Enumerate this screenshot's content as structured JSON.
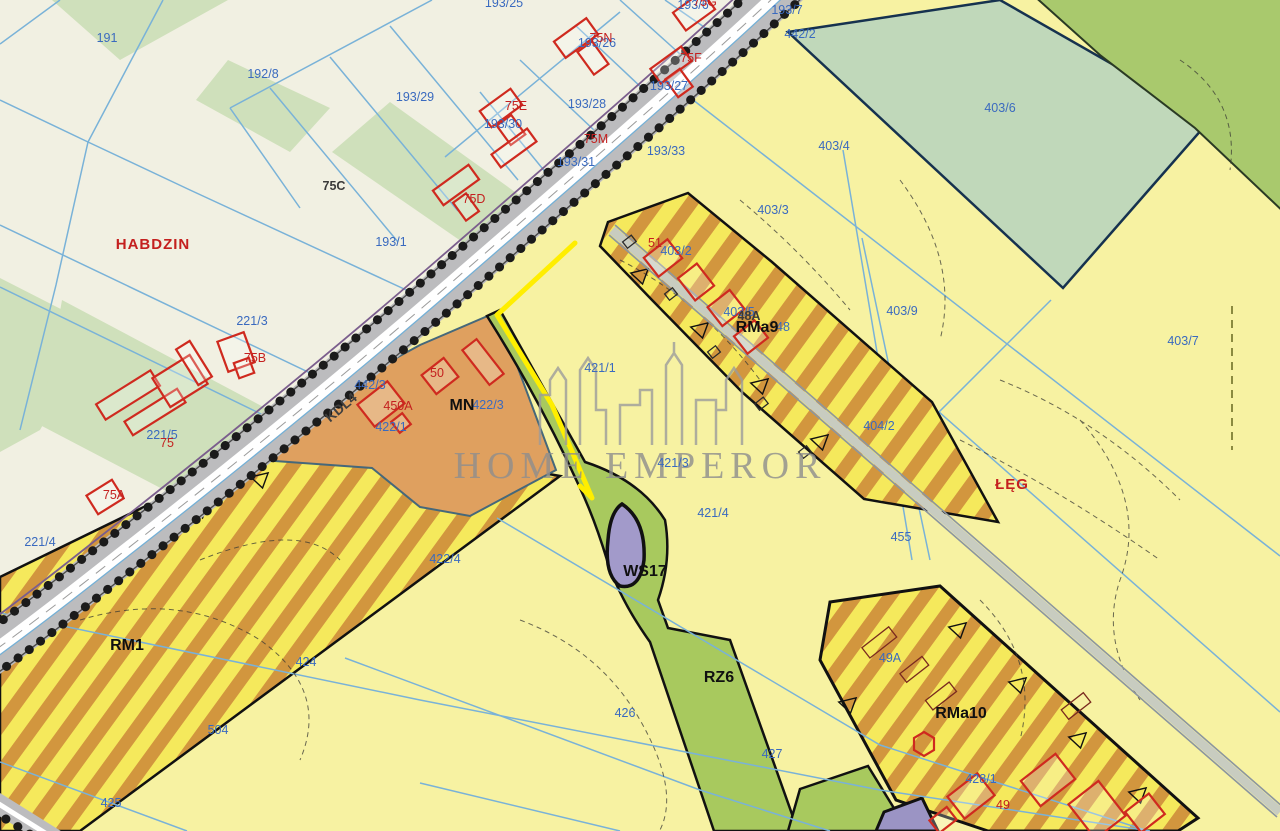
{
  "watermark": {
    "text": "HOME EMPEROR",
    "logo": "city-skyline-icon"
  },
  "colors": {
    "background_cream": "#f1f0e2",
    "parcel_yellow": "#f7f2a2",
    "stripe_yellow": "#f5e95c",
    "stripe_orange": "#d2963e",
    "zone_orange_mn": "#dfa05f",
    "zone_green": "#a8c95e",
    "forest_green": "#a9c96d",
    "meadow_sage": "#c0d8ba",
    "pond_purple": "#a29aca",
    "parcel_label_blue": "#3a6abf",
    "house_label_red": "#c4201f",
    "plan_boundary_yellow": "#ffee00",
    "nw_green_patch": "#cfe0bb"
  },
  "labels": [
    {
      "text": "191",
      "x": 107,
      "y": 42,
      "kind": "parcel"
    },
    {
      "text": "192/8",
      "x": 263,
      "y": 78,
      "kind": "parcel"
    },
    {
      "text": "193/29",
      "x": 415,
      "y": 101,
      "kind": "parcel"
    },
    {
      "text": "193/25",
      "x": 504,
      "y": 7,
      "kind": "parcel"
    },
    {
      "text": "193/26",
      "x": 597,
      "y": 47,
      "kind": "parcel"
    },
    {
      "text": "193/6",
      "x": 693,
      "y": 9,
      "kind": "parcel"
    },
    {
      "text": "193/7",
      "x": 787,
      "y": 14,
      "kind": "parcel"
    },
    {
      "text": "442/2",
      "x": 800,
      "y": 38,
      "kind": "parcel"
    },
    {
      "text": "193/27",
      "x": 669,
      "y": 90,
      "kind": "parcel"
    },
    {
      "text": "193/28",
      "x": 587,
      "y": 108,
      "kind": "parcel"
    },
    {
      "text": "193/30",
      "x": 503,
      "y": 128,
      "kind": "parcel"
    },
    {
      "text": "193/31",
      "x": 576,
      "y": 166,
      "kind": "parcel"
    },
    {
      "text": "193/33",
      "x": 666,
      "y": 155,
      "kind": "parcel"
    },
    {
      "text": "193/1",
      "x": 391,
      "y": 246,
      "kind": "parcel"
    },
    {
      "text": "221/3",
      "x": 252,
      "y": 325,
      "kind": "parcel"
    },
    {
      "text": "221/5",
      "x": 162,
      "y": 439,
      "kind": "parcel"
    },
    {
      "text": "221/4",
      "x": 40,
      "y": 546,
      "kind": "parcel"
    },
    {
      "text": "442/3",
      "x": 370,
      "y": 389,
      "kind": "parcel"
    },
    {
      "text": "422/1",
      "x": 391,
      "y": 431,
      "kind": "parcel"
    },
    {
      "text": "422/3",
      "x": 488,
      "y": 409,
      "kind": "parcel"
    },
    {
      "text": "422/4",
      "x": 445,
      "y": 563,
      "kind": "parcel"
    },
    {
      "text": "421/1",
      "x": 600,
      "y": 372,
      "kind": "parcel"
    },
    {
      "text": "421/3",
      "x": 673,
      "y": 467,
      "kind": "parcel"
    },
    {
      "text": "421/4",
      "x": 713,
      "y": 517,
      "kind": "parcel"
    },
    {
      "text": "403/2",
      "x": 676,
      "y": 255,
      "kind": "parcel"
    },
    {
      "text": "403/3",
      "x": 773,
      "y": 214,
      "kind": "parcel"
    },
    {
      "text": "403/4",
      "x": 834,
      "y": 150,
      "kind": "parcel"
    },
    {
      "text": "403/5",
      "x": 739,
      "y": 316,
      "kind": "parcel"
    },
    {
      "text": "403/6",
      "x": 1000,
      "y": 112,
      "kind": "parcel"
    },
    {
      "text": "403/9",
      "x": 902,
      "y": 315,
      "kind": "parcel"
    },
    {
      "text": "403/7",
      "x": 1183,
      "y": 345,
      "kind": "parcel"
    },
    {
      "text": "404/2",
      "x": 879,
      "y": 430,
      "kind": "parcel"
    },
    {
      "text": "455",
      "x": 901,
      "y": 541,
      "kind": "parcel"
    },
    {
      "text": "424",
      "x": 306,
      "y": 666,
      "kind": "parcel"
    },
    {
      "text": "504",
      "x": 218,
      "y": 734,
      "kind": "parcel"
    },
    {
      "text": "425",
      "x": 111,
      "y": 807,
      "kind": "parcel"
    },
    {
      "text": "426",
      "x": 625,
      "y": 717,
      "kind": "parcel"
    },
    {
      "text": "427",
      "x": 772,
      "y": 758,
      "kind": "parcel"
    },
    {
      "text": "428/1",
      "x": 981,
      "y": 783,
      "kind": "parcel"
    },
    {
      "text": "49A",
      "x": 890,
      "y": 662,
      "kind": "parcel"
    },
    {
      "text": "48",
      "x": 783,
      "y": 331,
      "kind": "parcel"
    },
    {
      "text": "75G",
      "x": 705,
      "y": 6,
      "kind": "house"
    },
    {
      "text": "75N",
      "x": 601,
      "y": 42,
      "kind": "house"
    },
    {
      "text": "75F",
      "x": 691,
      "y": 62,
      "kind": "house"
    },
    {
      "text": "75E",
      "x": 516,
      "y": 110,
      "kind": "house"
    },
    {
      "text": "75M",
      "x": 596,
      "y": 143,
      "kind": "house"
    },
    {
      "text": "75D",
      "x": 474,
      "y": 203,
      "kind": "house"
    },
    {
      "text": "75B",
      "x": 255,
      "y": 362,
      "kind": "house"
    },
    {
      "text": "75",
      "x": 167,
      "y": 447,
      "kind": "house"
    },
    {
      "text": "75A",
      "x": 114,
      "y": 499,
      "kind": "house"
    },
    {
      "text": "50",
      "x": 437,
      "y": 377,
      "kind": "house"
    },
    {
      "text": "450A",
      "x": 398,
      "y": 410,
      "kind": "house"
    },
    {
      "text": "51",
      "x": 655,
      "y": 247,
      "kind": "house"
    },
    {
      "text": "49",
      "x": 1003,
      "y": 809,
      "kind": "house"
    },
    {
      "text": "75C",
      "x": 334,
      "y": 190,
      "kind": "house-dark"
    },
    {
      "text": "48A",
      "x": 749,
      "y": 320,
      "kind": "house-dark"
    },
    {
      "text": "MN",
      "x": 462,
      "y": 410,
      "kind": "zone"
    },
    {
      "text": "RM1",
      "x": 127,
      "y": 650,
      "kind": "zone"
    },
    {
      "text": "RMa9",
      "x": 757,
      "y": 332,
      "kind": "zone"
    },
    {
      "text": "RMa10",
      "x": 961,
      "y": 718,
      "kind": "zone"
    },
    {
      "text": "RZ6",
      "x": 719,
      "y": 682,
      "kind": "zone"
    },
    {
      "text": "WS17",
      "x": 645,
      "y": 576,
      "kind": "zone"
    },
    {
      "text": "KDL4",
      "x": 344,
      "y": 411,
      "kind": "road",
      "rot": -40
    },
    {
      "text": "HABDZIN",
      "x": 153,
      "y": 249,
      "kind": "place"
    },
    {
      "text": "ŁĘG",
      "x": 1012,
      "y": 489,
      "kind": "place"
    }
  ]
}
